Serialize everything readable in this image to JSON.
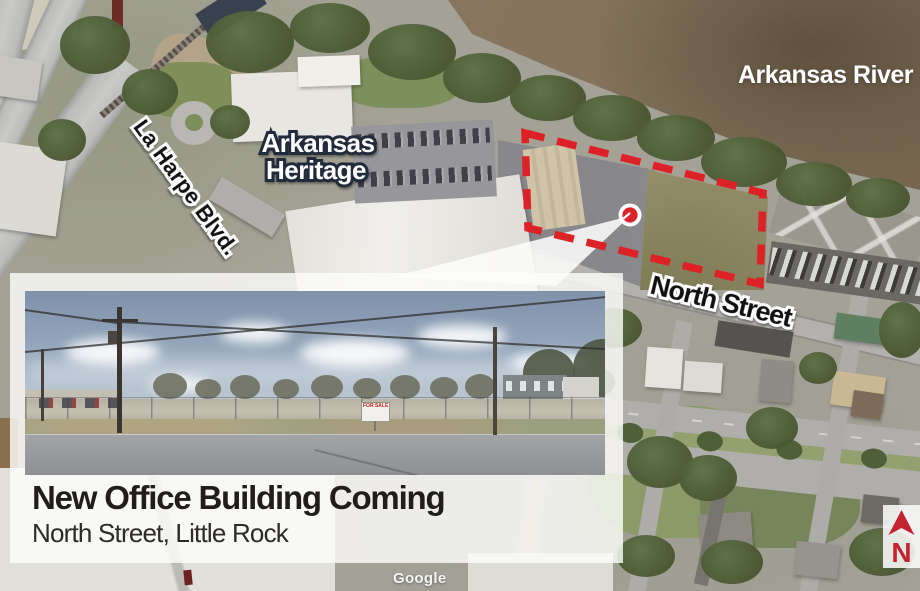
{
  "map": {
    "labels": {
      "river": "Arkansas River",
      "heritage_line1": "Arkansas",
      "heritage_line2": "Heritage",
      "la_harpe": "La Harpe Blvd.",
      "north_street": "North Street"
    },
    "watermark": "Google",
    "compass_letter": "N",
    "colors": {
      "parcel_outline_red": "#dc2127",
      "marker_red": "#dc2127",
      "compass_red": "#c42430",
      "river_brown": "#83735c"
    }
  },
  "callout": {
    "title": "New Office Building Coming",
    "subtitle": "North Street, Little Rock"
  },
  "inset_photo": {
    "sign_text": "FOR SALE"
  }
}
